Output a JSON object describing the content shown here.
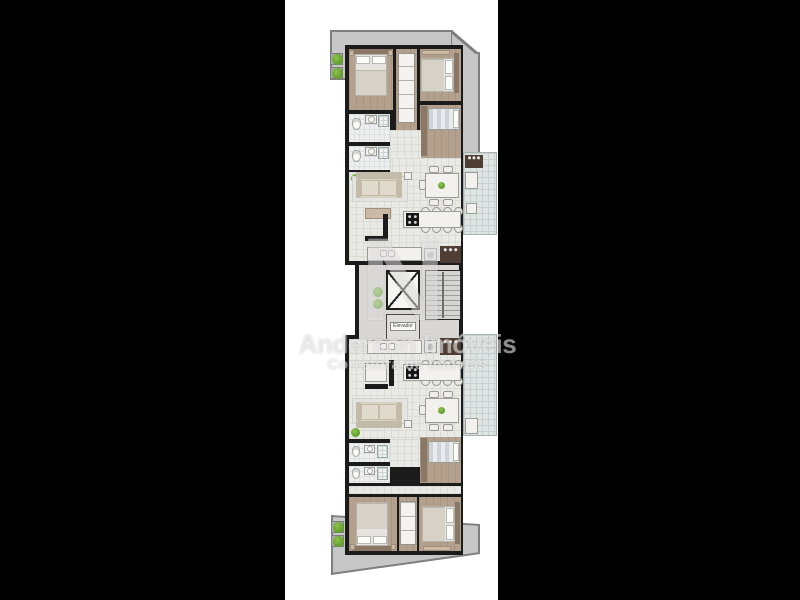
{
  "scene": {
    "description": "Photo of an architectural floor plan (two mirrored apartment units around a central elevator/stair core) letterboxed on a black background",
    "background": "#000000",
    "photo_background": "#ffffff"
  },
  "watermark": {
    "logo_letter": "N",
    "brand_line": "Anderson Imóveis",
    "tagline": "Corretora de Imóveis"
  },
  "floorplan": {
    "core": {
      "elevator_label": "Elevador",
      "elements": [
        "elevator-shaft-x",
        "labeled-elevator",
        "staircase",
        "plants"
      ]
    },
    "units": [
      {
        "name": "apartment-top",
        "rooms": [
          "bedroom-left",
          "closet-hall",
          "bedroom-right",
          "bathroom-1",
          "bathroom-2",
          "small-bedroom",
          "living-dining",
          "kitchen",
          "service",
          "balcony"
        ]
      },
      {
        "name": "apartment-bottom",
        "rooms": [
          "kitchen",
          "service",
          "living-dining",
          "bathroom-1",
          "bathroom-2",
          "small-bedroom",
          "bedroom-left",
          "closet-hall",
          "bedroom-right",
          "balcony"
        ]
      }
    ],
    "outdoor": [
      "top-terrace",
      "bottom-terrace",
      "planters"
    ]
  },
  "colors": {
    "background": "#000000",
    "photo_background": "#ffffff",
    "wall": "#1b1b1b",
    "terrace": "#c7c7c7",
    "terrace_border": "#7f7f7f",
    "wood_floor": "#b3a08d",
    "tile_floor": "#e9eae6",
    "tile_line": "#dbdcd6",
    "balcony_floor": "#dfe5e3",
    "balcony_line": "#c9d2d0",
    "core_floor": "#d8d7d3",
    "furniture_white": "#f2f1ee",
    "headboard_wood": "#8a7766",
    "appliance_dark": "#4e3e33",
    "cooktop_black": "#161616",
    "plant_green": "#5f9b2d",
    "stairs_line": "#9b9b9b",
    "watermark": "rgba(255,255,255,0.5)"
  }
}
